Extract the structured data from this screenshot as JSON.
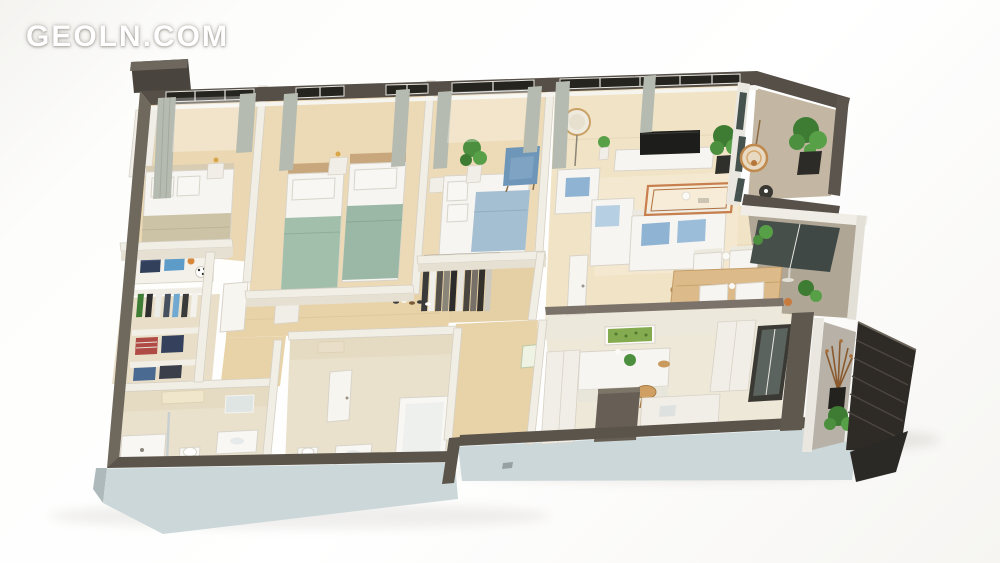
{
  "watermark": {
    "text": "GEOLN.COM"
  },
  "scene": {
    "description": "Isometric 3D render of a three-bedroom apartment floor plan on a white background",
    "rooms": [
      {
        "id": "bedroom-1",
        "label": "Bedroom with double bed and wardrobe"
      },
      {
        "id": "bedroom-2",
        "label": "Bedroom with two single beds"
      },
      {
        "id": "bedroom-3",
        "label": "Bedroom with single bed, armchair and plant"
      },
      {
        "id": "living-room",
        "label": "Living room with TV, sofa and coffee table"
      },
      {
        "id": "dining-area",
        "label": "Dining table with four white chairs"
      },
      {
        "id": "kitchen",
        "label": "Kitchen with island and two bar stools"
      },
      {
        "id": "hallway",
        "label": "Hallway with coat rack"
      },
      {
        "id": "wardrobe-room",
        "label": "Walk-in wardrobe with folded clothes"
      },
      {
        "id": "bathroom-1",
        "label": "Bathroom with shower"
      },
      {
        "id": "bathroom-2",
        "label": "Bathroom with bathtub"
      },
      {
        "id": "entry",
        "label": "Entrance zone"
      },
      {
        "id": "balcony-top",
        "label": "Balcony with hanging chair and plant"
      },
      {
        "id": "balcony-middle",
        "label": "Loggia with plants"
      },
      {
        "id": "balcony-bottom",
        "label": "Balcony with dark slatted screen and plants"
      }
    ],
    "colors": {
      "outer_wall": "#554f47",
      "outer_wall_light": "#6f685d",
      "bottom_wall": "#5a544b",
      "plinth": "#ccd7d9",
      "inner_wall": "#f1eee6",
      "wood_floor": "#ecd9b5",
      "tile_floor": "#eae1cd",
      "accent_teal": "#a2bfab",
      "accent_blue": "#a4bed2",
      "pillow_blue": "#8fb3d3",
      "plant_green": "#4c8f3e",
      "copper": "#c77f4e",
      "tv_black": "#1d1d1b"
    }
  }
}
